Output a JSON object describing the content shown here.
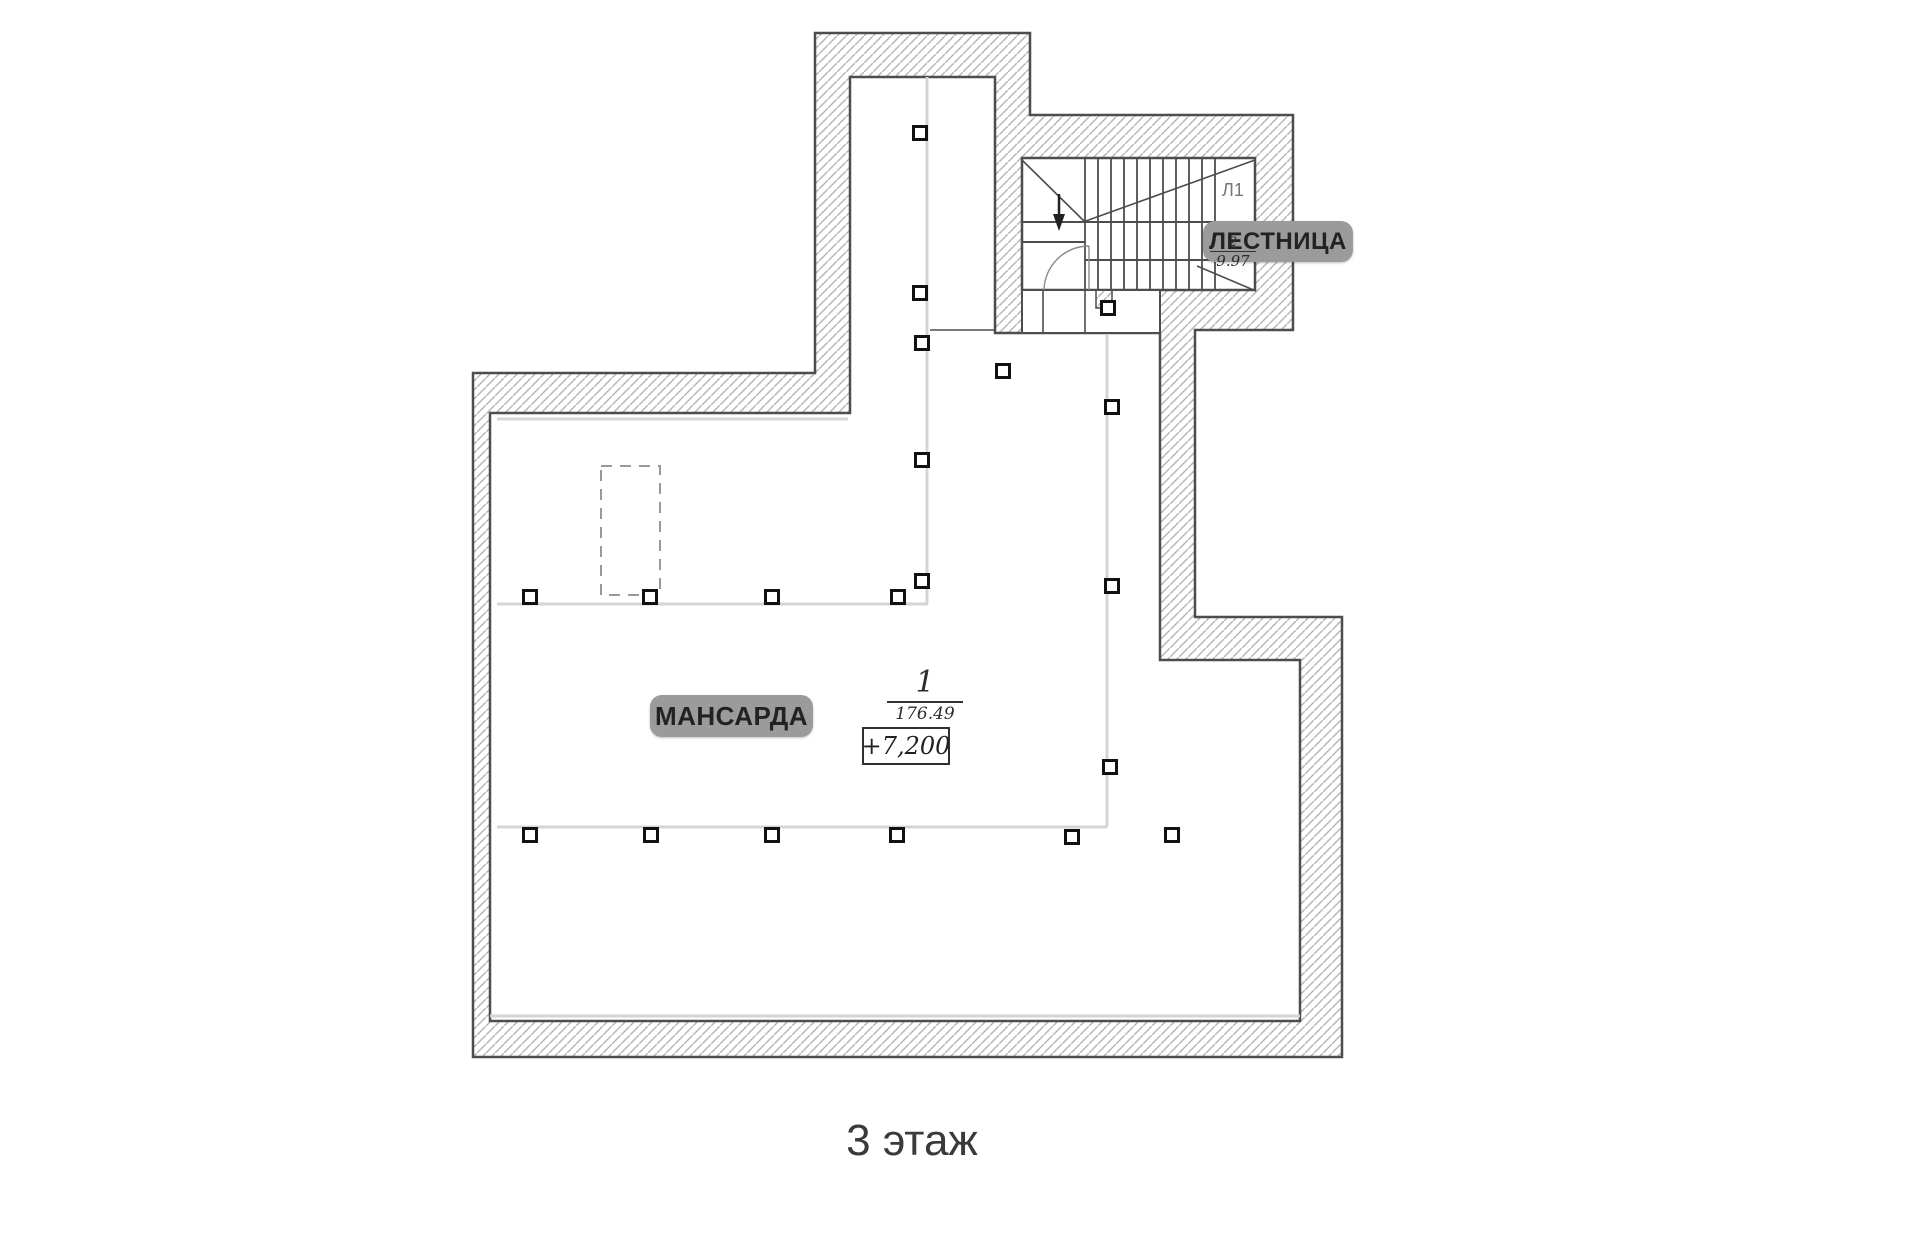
{
  "caption": "3 этаж",
  "labels": {
    "room_tag": "МАНСАРДА",
    "stair_tag": "ЛЕСТНИЦА",
    "stair_code": "Л1",
    "elevation": "+7,200",
    "room_marker": {
      "number": "1",
      "area": "176.49"
    },
    "stair_marker": {
      "number": "2",
      "area": "9.97"
    }
  },
  "colors": {
    "wall_stroke": "#4d4d4d",
    "hatch_line": "#b6b6b6",
    "light_line": "#d4d4d4",
    "tag_bg": "#9b9b9b",
    "tag_text": "#222222",
    "marker_stroke": "#111111"
  },
  "plan": {
    "column_markers": [
      [
        920,
        133
      ],
      [
        920,
        293
      ],
      [
        922,
        343
      ],
      [
        1003,
        371
      ],
      [
        1108,
        308
      ],
      [
        1112,
        407
      ],
      [
        922,
        460
      ],
      [
        922,
        581
      ],
      [
        898,
        597
      ],
      [
        530,
        597
      ],
      [
        650,
        597
      ],
      [
        772,
        597
      ],
      [
        1112,
        586
      ],
      [
        1110,
        767
      ],
      [
        530,
        835
      ],
      [
        651,
        835
      ],
      [
        772,
        835
      ],
      [
        897,
        835
      ],
      [
        1072,
        837
      ],
      [
        1172,
        835
      ]
    ],
    "light_lines": [
      [
        927,
        77,
        927,
        604
      ],
      [
        497,
        604,
        928,
        604
      ],
      [
        497,
        827,
        1107,
        827
      ],
      [
        1107,
        333,
        1107,
        827
      ],
      [
        490,
        1016,
        1300,
        1016
      ],
      [
        497,
        419,
        848,
        419
      ]
    ],
    "dashed_rect": {
      "x": 601,
      "y": 466,
      "w": 59,
      "h": 129
    },
    "stairs": {
      "x_start": 1085,
      "x_end": 1215,
      "tread_count": 11,
      "y_top": 158,
      "y_bottom": 290
    }
  }
}
